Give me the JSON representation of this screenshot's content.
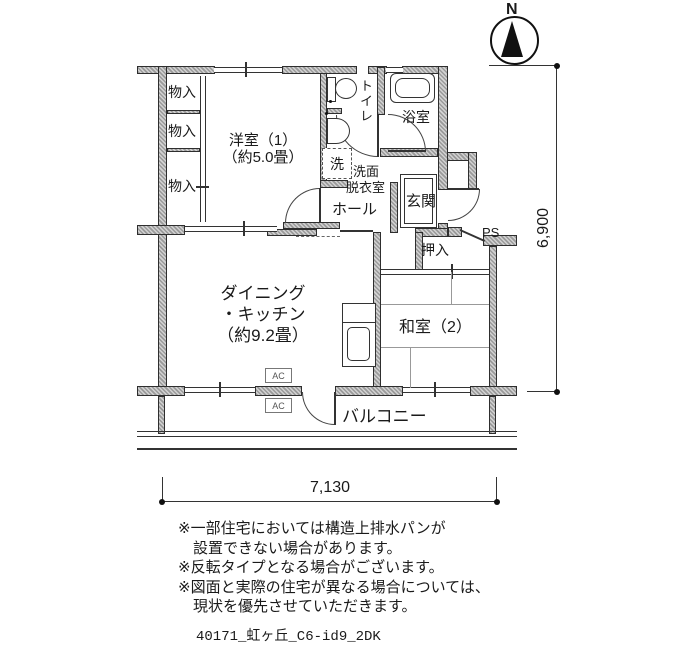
{
  "compass": {
    "north_label": "N"
  },
  "labels": {
    "storage1": "物入",
    "storage2": "物入",
    "storage3": "物入",
    "western_room_name": "洋室（1）",
    "western_room_size": "（約5.0畳）",
    "toilet": "トイレ",
    "bath": "浴室",
    "laundry": "洗",
    "washroom_line1": "洗面",
    "washroom_line2": "脱衣室",
    "hall": "ホール",
    "entrance": "玄関",
    "ps": "PS",
    "oshiire": "押入",
    "dk_line1": "ダイニング",
    "dk_line2": "・キッチン",
    "dk_line3": "（約9.2畳）",
    "japanese_room": "和室（2）",
    "balcony": "バルコニー",
    "ac_upper": "AC",
    "ac_lower": "AC"
  },
  "dimensions": {
    "horizontal": "7,130",
    "vertical": "6,900"
  },
  "notes": [
    "※一部住宅においては構造上排水パンが",
    "　設置できない場合があります。",
    "※反転タイプとなる場合がございます。",
    "※図面と実際の住宅が異なる場合については、",
    "　現状を優先させていただきます。"
  ],
  "footer": "40171_虹ヶ丘_C6-id9_2DK",
  "colors": {
    "wall_fill": "#b5b5b5",
    "line": "#333333"
  }
}
